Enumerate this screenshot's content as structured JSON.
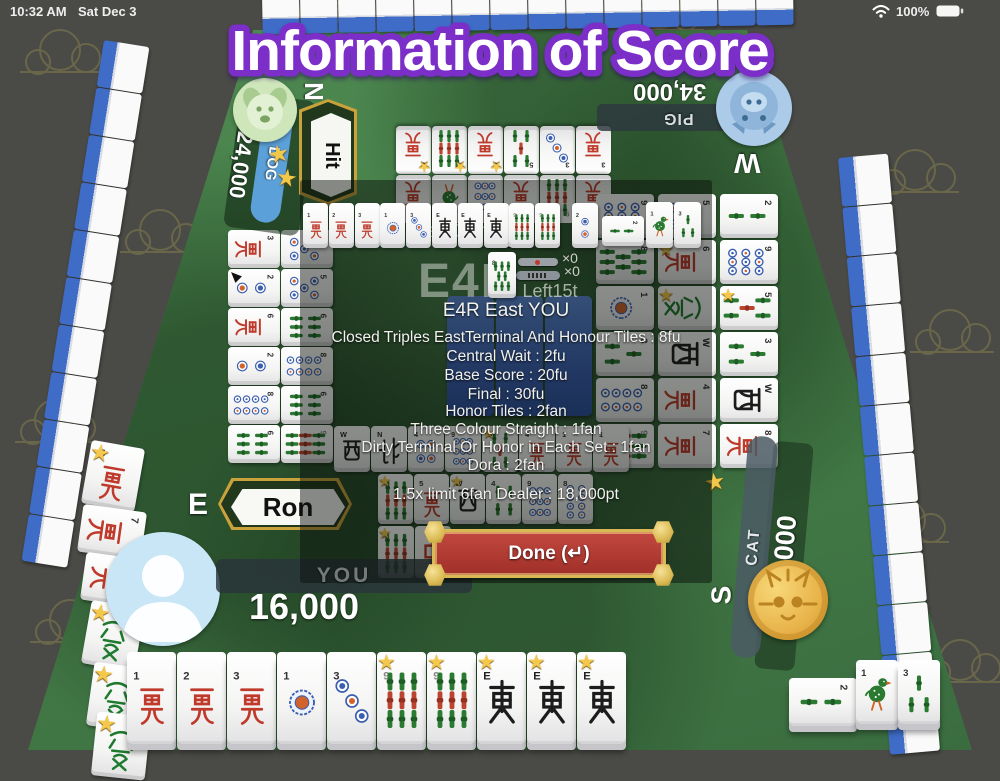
{
  "status_bar": {
    "time": "10:32 AM",
    "date": "Sat Dec 3",
    "battery_percent": "100%"
  },
  "title": "Information of Score",
  "players": {
    "north": {
      "name": "DOG",
      "score": "24,000",
      "seat": "N",
      "stars": 2,
      "callout": "Hit",
      "avatar": "dog-icon",
      "bar_color": "#5ba0d8"
    },
    "west": {
      "name": "PIG",
      "score": "34,000",
      "seat": "W",
      "avatar": "pig-icon"
    },
    "south": {
      "name": "CAT",
      "score": "24,000",
      "seat": "S",
      "stars": 1,
      "avatar": "cat-coin-icon"
    },
    "you": {
      "name": "YOU",
      "score": "16,000",
      "seat": "E",
      "callout": "Ron",
      "avatar": "person-icon"
    }
  },
  "score_panel": {
    "match_label": "Half Game",
    "round_label": "E4R",
    "dora_label": "Dora",
    "riichi_counter": "×0",
    "hundred_counter": "×0",
    "tiles_left": "Left15t",
    "winner_line": "E4R East YOU",
    "fu_lines": [
      "Closed Triples EastTerminal And Honour Tiles : 8fu",
      "Central Wait : 2fu",
      "Base Score : 20fu",
      "Final : 30fu"
    ],
    "fan_lines": [
      "Honor Tiles : 2fan",
      "Three Colour Straight : 1fan",
      "Dirty Terminal Or Honor in Each Set : 1fan",
      "Dora : 2fan"
    ],
    "result_line": "1.5x limit 6fan Dealer : 18,000pt",
    "done_button": "Done (↵)"
  },
  "tile_groups": {
    "winning_hand": [
      "1man",
      "2man",
      "3man",
      "1pin",
      "3pin",
      "east",
      "east",
      "east",
      "9sou",
      "9sou"
    ],
    "winning_tile": [
      "2pin"
    ],
    "winning_meld_side": [
      "2sou-"
    ],
    "winning_meld_up": [
      "1sou",
      "3sou"
    ],
    "dora_indicator": [
      "8sou"
    ],
    "hand": [
      "1man",
      "2man",
      "3man",
      "1pin",
      "3pin",
      "9sou*",
      "9sou*",
      "east*",
      "east*",
      "east*"
    ],
    "hand_meld_side": [
      "2sou-"
    ],
    "hand_meld_up": [
      "1sou",
      "3sou"
    ],
    "north_discards": [
      "9man*",
      "9sou*",
      "5man*",
      "5sou",
      "3pin",
      "3man",
      "7man",
      "1sou",
      "9pin",
      "5man",
      "9sou",
      "2man"
    ],
    "east_discards": [
      "3man-",
      "5pin-",
      "2pin>-",
      "5pin-",
      "6man-",
      "6sou-",
      "2pin-",
      "8pin-",
      "8pin-",
      "6sou-",
      "6sou-",
      "9sou-"
    ],
    "west_discards": [
      "9pin-",
      "5pin-",
      "2sou-",
      "8sou-",
      "6man*-",
      "9pin-",
      "1pin-",
      "green*-",
      "5sou*-",
      "3sou-",
      "west-",
      "3sou-",
      "8pin-",
      "4man-",
      "west-",
      "9sou-",
      "7man-",
      "8man-"
    ],
    "south_row1": [
      "west",
      "north",
      "4pin",
      "9pin",
      "5sou*",
      "4man",
      "1man",
      "1man"
    ],
    "south_row2": [
      "9sou*",
      "5man",
      "west*",
      "4sou",
      "9pin",
      "8pin"
    ],
    "south_row3": [
      "9sou*",
      "red"
    ],
    "left_col_1": [
      "5man*"
    ],
    "left_col_2": [
      "7man-"
    ],
    "left_col_3": [
      "7man-"
    ],
    "left_col_4": [
      "green*"
    ],
    "left_col_5": [
      "green*"
    ],
    "left_col_6": [
      "green*"
    ],
    "dead_wall_backs": [
      "back",
      "back",
      "back"
    ]
  },
  "walls": {
    "top_count": 14,
    "left_count": 11,
    "right_count": 12
  }
}
